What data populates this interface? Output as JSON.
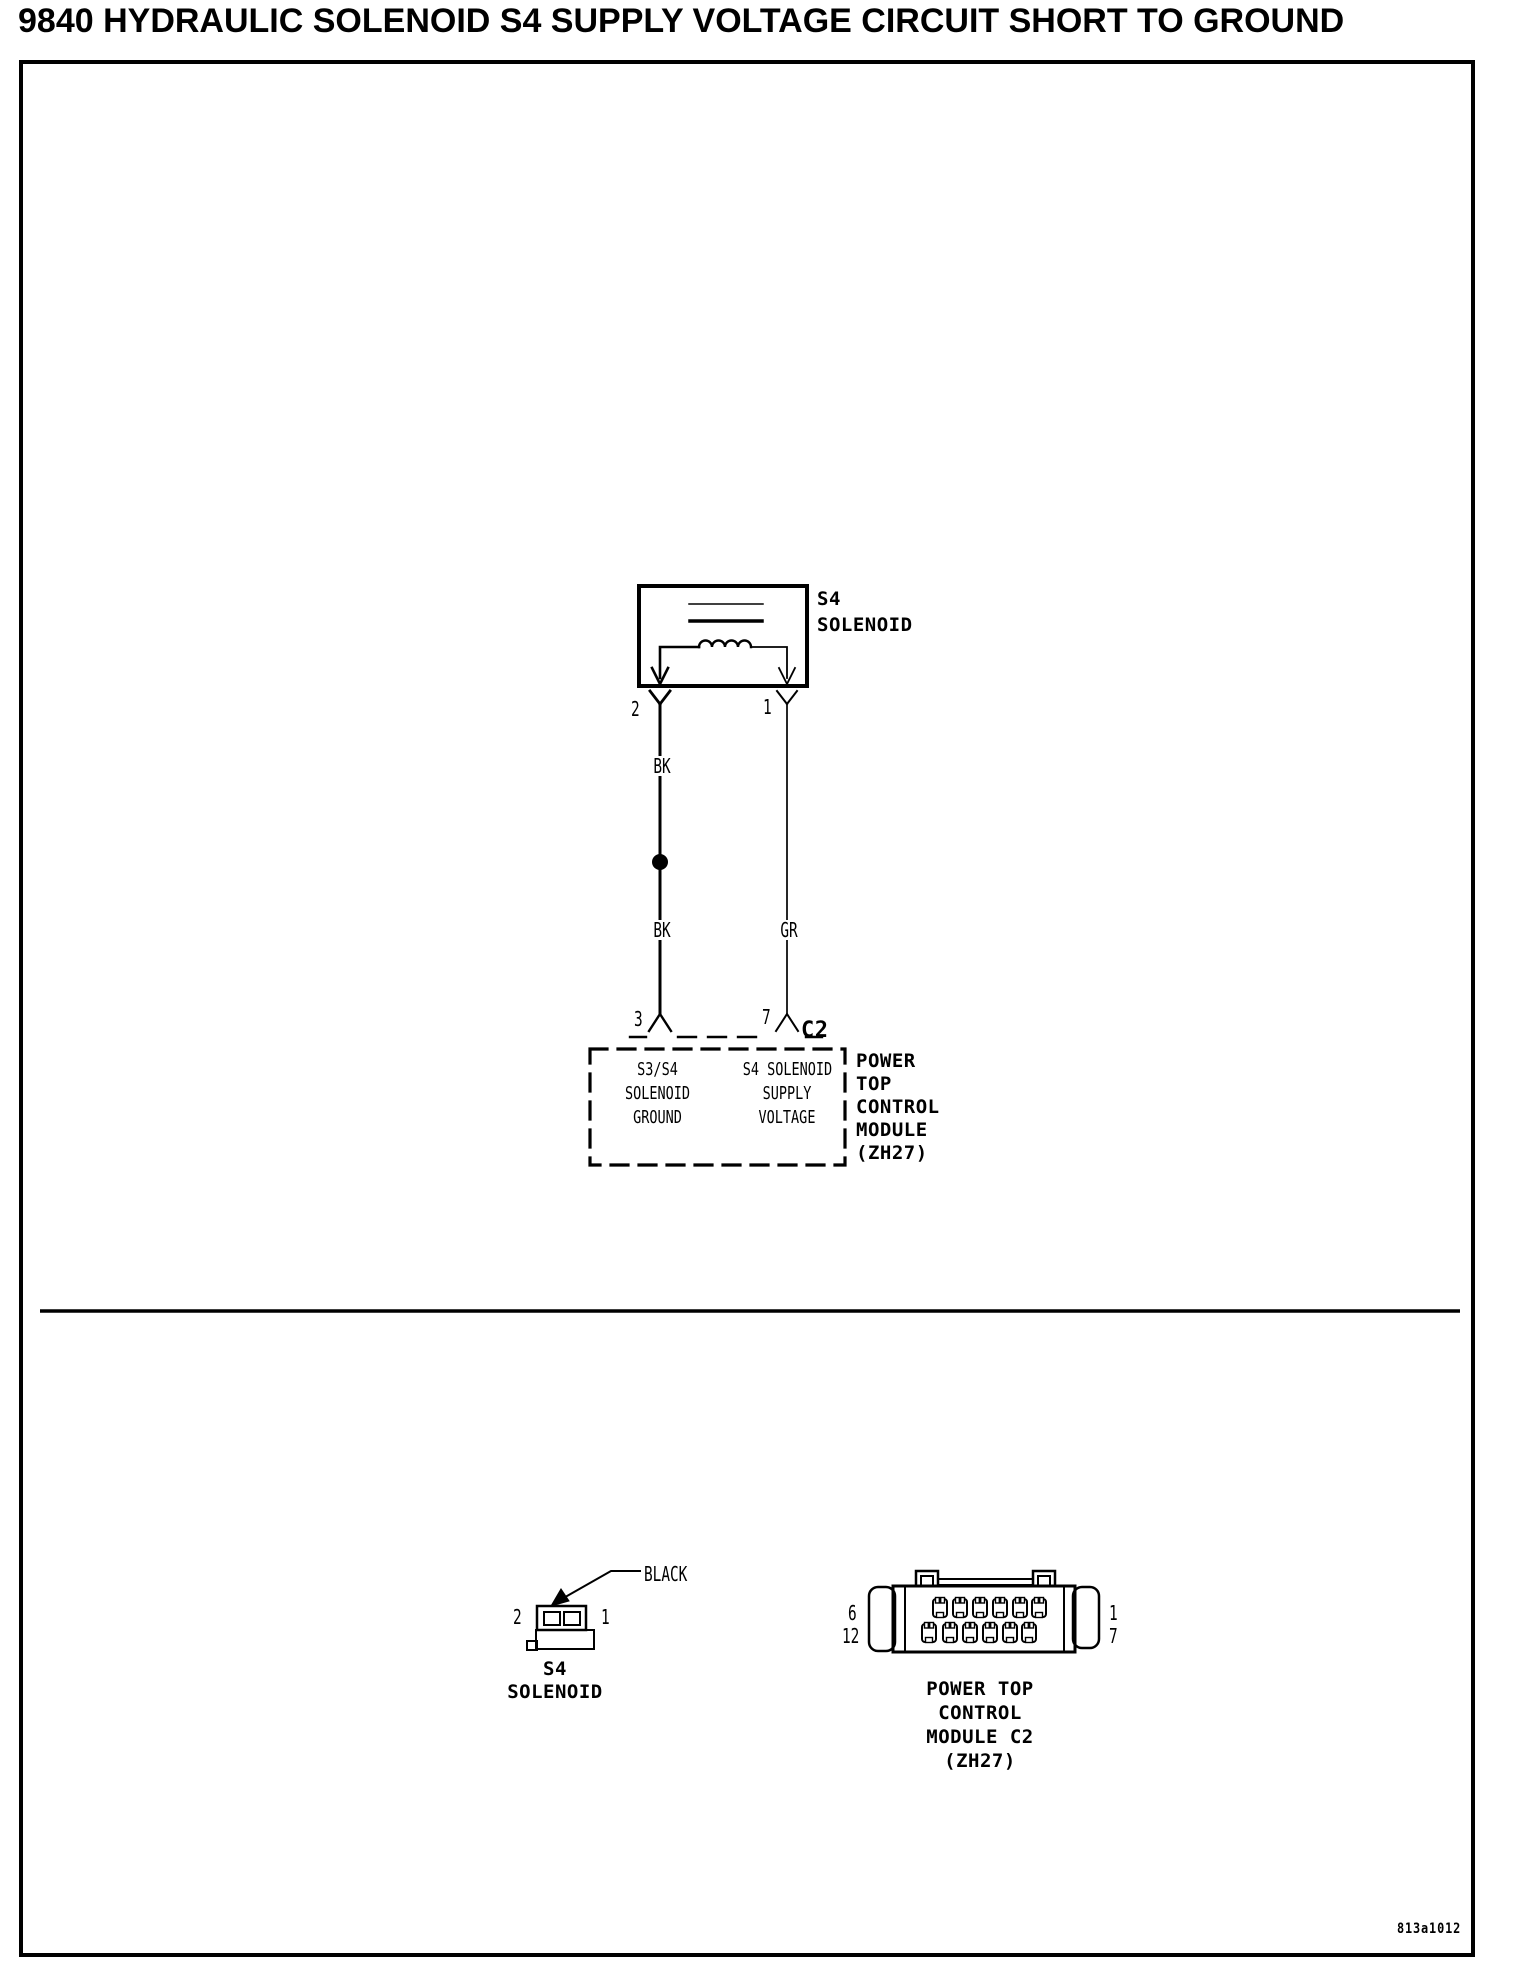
{
  "page": {
    "title": "9840 HYDRAULIC SOLENOID S4 SUPPLY VOLTAGE CIRCUIT SHORT TO GROUND",
    "figure_code": "813a1012"
  },
  "schematic": {
    "solenoid": {
      "name_lines": [
        "S4",
        "SOLENOID"
      ],
      "pin_left": "2",
      "pin_right": "1"
    },
    "wires": {
      "left_color_upper": "BK",
      "left_color_lower": "BK",
      "right_color": "GR"
    },
    "module": {
      "pin_left": "3",
      "pin_right": "7",
      "connector_label": "C2",
      "pin_left_function_lines": [
        "S3/S4",
        "SOLENOID",
        "GROUND"
      ],
      "pin_right_function_lines": [
        "S4 SOLENOID",
        "SUPPLY",
        "VOLTAGE"
      ],
      "name_lines": [
        "POWER",
        "TOP",
        "CONTROL",
        "MODULE",
        "(ZH27)"
      ]
    }
  },
  "connector_views": {
    "solenoid_connector": {
      "color_label": "BLACK",
      "pin_left": "2",
      "pin_right": "1",
      "name_lines": [
        "S4",
        "SOLENOID"
      ]
    },
    "module_connector": {
      "pin_top_left": "6",
      "pin_bottom_left": "12",
      "pin_top_right": "1",
      "pin_bottom_right": "7",
      "name_lines": [
        "POWER TOP",
        "CONTROL",
        "MODULE C2",
        "(ZH27)"
      ]
    }
  }
}
